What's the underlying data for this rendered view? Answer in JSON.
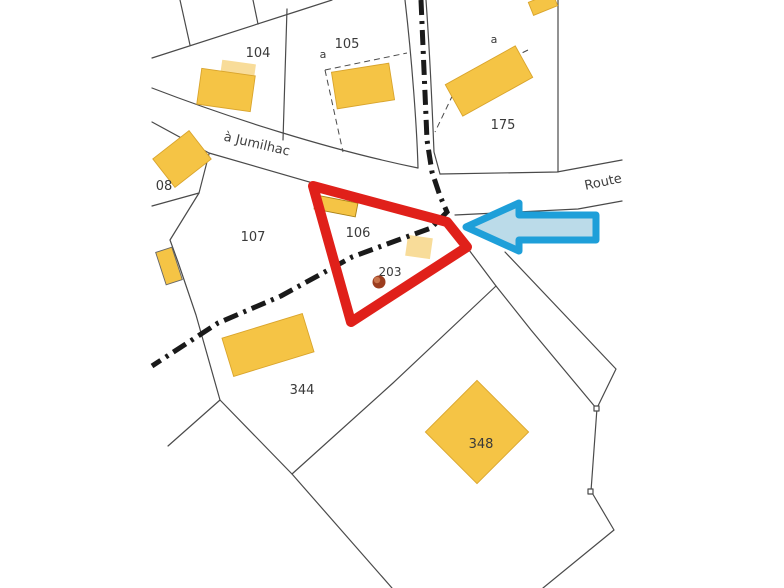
{
  "map": {
    "title": "cadastral-parcel-map",
    "parcels": {
      "p104": "104",
      "p105": "105",
      "p175": "175",
      "p108": "08",
      "p107": "107",
      "p106": "106",
      "p203": "203",
      "p344": "344",
      "p348": "348",
      "sub_a_105": "a",
      "sub_a_175": "a"
    },
    "roads": {
      "jumilhac": "à Jumilhac",
      "route": "Route"
    },
    "colors": {
      "building": "#F5C445",
      "building_light": "#F8DC99",
      "building_edge": "#D9A42C",
      "highlight_red": "#E0201A",
      "arrow_fill": "#BBDBE9",
      "arrow_stroke": "#1E9FD9",
      "boundary_line": "#4A4A4A",
      "centerline": "#1A1A1A",
      "marker_dot": "#9C3D1F",
      "marker_dot_highlight": "#C8734B"
    }
  }
}
